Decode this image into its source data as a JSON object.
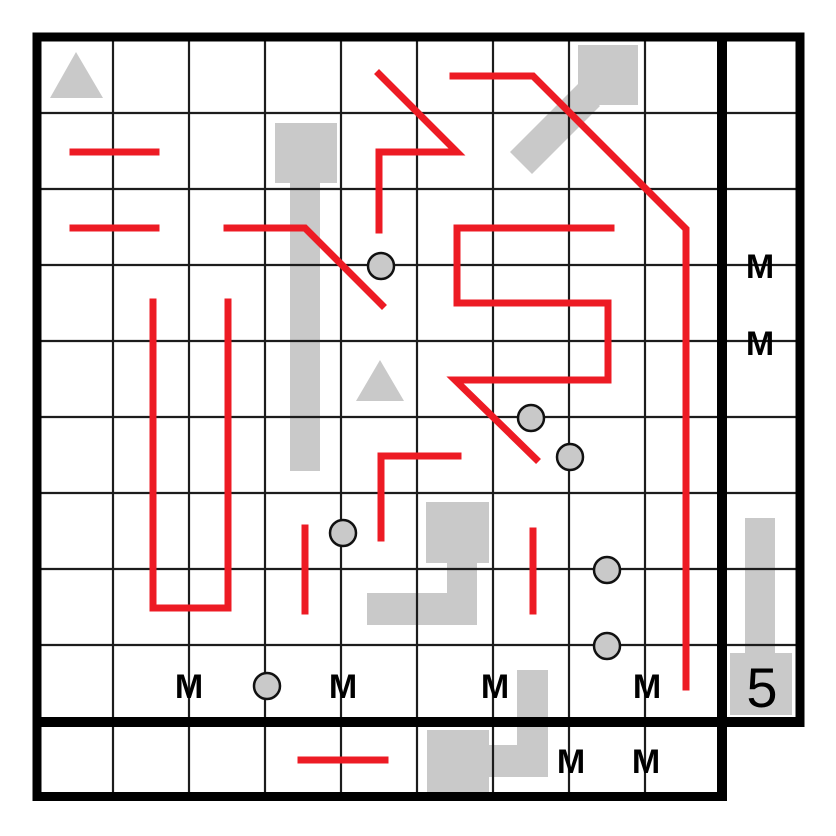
{
  "title": "Logic puzzle grid with red solution lines, gray pieces, circle markers, M clues and count clue 5",
  "canvas": {
    "width": 836,
    "height": 836
  },
  "colors": {
    "background": "#ffffff",
    "red": "#ed1b24",
    "shape_gray": "#c9c9c9",
    "circle_fill": "#c9c9c9",
    "circle_stroke": "#111111",
    "grid_thin": "#1c1c1c",
    "grid_bold": "#000000",
    "text": "#000000"
  },
  "grid": {
    "thin_width": 2.2,
    "bold_width": 9,
    "inner_bold_width": 10,
    "thin_vertical_x": [
      113,
      189,
      265,
      341,
      417,
      493,
      569,
      645
    ],
    "thin_vertical_span": [
      37,
      796
    ],
    "thin_horizontal_y": [
      113,
      189,
      265,
      341,
      417,
      493,
      569,
      645
    ],
    "thin_horizontal_span": [
      37,
      800
    ],
    "bold_lines": [
      {
        "x1": 32.5,
        "y1": 37,
        "x2": 804.5,
        "y2": 37,
        "w": 9
      },
      {
        "x1": 37,
        "y1": 32.5,
        "x2": 37,
        "y2": 801,
        "w": 9
      },
      {
        "x1": 800,
        "y1": 32.5,
        "x2": 800,
        "y2": 726.5,
        "w": 9
      },
      {
        "x1": 722,
        "y1": 32.5,
        "x2": 722,
        "y2": 801,
        "w": 10
      },
      {
        "x1": 32.5,
        "y1": 722,
        "x2": 804.5,
        "y2": 722,
        "w": 10
      },
      {
        "x1": 32.5,
        "y1": 796.5,
        "x2": 727,
        "y2": 796.5,
        "w": 9
      }
    ]
  },
  "red_line_width": 7,
  "red_paths": [
    {
      "name": "red-segment-row2-left",
      "points": [
        [
          73,
          152
        ],
        [
          156,
          152
        ]
      ]
    },
    {
      "name": "red-segment-row3-left",
      "points": [
        [
          73,
          228
        ],
        [
          156,
          228
        ]
      ]
    },
    {
      "name": "red-path-row3-diagonal",
      "points": [
        [
          227,
          228
        ],
        [
          305,
          228
        ],
        [
          382,
          305
        ]
      ]
    },
    {
      "name": "red-zigzag-top-middle",
      "points": [
        [
          379,
          74
        ],
        [
          457,
          152
        ],
        [
          379,
          152
        ],
        [
          379,
          230
        ]
      ]
    },
    {
      "name": "red-long-path-right",
      "points": [
        [
          453,
          76
        ],
        [
          533,
          76
        ],
        [
          686,
          229
        ],
        [
          686,
          687
        ]
      ]
    },
    {
      "name": "red-s-path-middle",
      "points": [
        [
          611,
          228
        ],
        [
          457,
          228
        ],
        [
          457,
          303
        ],
        [
          608,
          303
        ],
        [
          608,
          380
        ],
        [
          455,
          380
        ],
        [
          536,
          459
        ]
      ]
    },
    {
      "name": "red-u-path-left",
      "points": [
        [
          153,
          302
        ],
        [
          153,
          608
        ],
        [
          228,
          608
        ],
        [
          228,
          302
        ]
      ]
    },
    {
      "name": "red-l-path-center",
      "points": [
        [
          458,
          456
        ],
        [
          381,
          456
        ],
        [
          381,
          538
        ]
      ]
    },
    {
      "name": "red-segment-col4-vert",
      "points": [
        [
          305,
          528
        ],
        [
          305,
          611
        ]
      ]
    },
    {
      "name": "red-segment-col7-vert",
      "points": [
        [
          533,
          531
        ],
        [
          533,
          611
        ]
      ]
    },
    {
      "name": "red-segment-bottom-row",
      "points": [
        [
          301,
          760
        ],
        [
          385,
          760
        ]
      ]
    }
  ],
  "gray_pieces": [
    {
      "name": "gray-pin-down-col4",
      "polygons": [
        [
          [
            275,
            123
          ],
          [
            337,
            123
          ],
          [
            337,
            183
          ],
          [
            320,
            183
          ],
          [
            320,
            471
          ],
          [
            290,
            471
          ],
          [
            290,
            183
          ],
          [
            275,
            183
          ]
        ]
      ]
    },
    {
      "name": "gray-pin-diagonal-topright",
      "polygons": [
        [
          [
            578,
            45
          ],
          [
            638,
            45
          ],
          [
            638,
            105
          ],
          [
            578,
            105
          ]
        ],
        [
          [
            510,
            152
          ],
          [
            532,
            174
          ],
          [
            600,
            106
          ],
          [
            578,
            84
          ]
        ]
      ]
    },
    {
      "name": "gray-s-piece-middle",
      "polygons": [
        [
          [
            426,
            502
          ],
          [
            489,
            502
          ],
          [
            489,
            563
          ],
          [
            477,
            563
          ],
          [
            477,
            625
          ],
          [
            367,
            625
          ],
          [
            367,
            593
          ],
          [
            447,
            593
          ],
          [
            447,
            563
          ],
          [
            426,
            563
          ]
        ]
      ]
    },
    {
      "name": "gray-s-piece-bottom",
      "polygons": [
        [
          [
            517,
            670
          ],
          [
            548,
            670
          ],
          [
            548,
            777
          ],
          [
            489,
            777
          ],
          [
            489,
            792
          ],
          [
            427,
            792
          ],
          [
            427,
            730
          ],
          [
            489,
            730
          ],
          [
            489,
            745
          ],
          [
            517,
            745
          ]
        ]
      ]
    },
    {
      "name": "gray-pin-up-rightcolumn",
      "polygons": [
        [
          [
            745,
            518
          ],
          [
            775,
            518
          ],
          [
            775,
            653
          ],
          [
            792,
            653
          ],
          [
            792,
            715
          ],
          [
            730,
            715
          ],
          [
            730,
            653
          ],
          [
            745,
            653
          ]
        ]
      ]
    }
  ],
  "triangles": [
    {
      "name": "triangle-marker-top-left",
      "points": [
        [
          76,
          52
        ],
        [
          50,
          98
        ],
        [
          103,
          98
        ]
      ]
    },
    {
      "name": "triangle-marker-center",
      "points": [
        [
          380,
          360
        ],
        [
          356,
          401
        ],
        [
          404,
          401
        ]
      ]
    }
  ],
  "circle_radius": 13,
  "circles": [
    {
      "cx": 381,
      "cy": 266
    },
    {
      "cx": 531,
      "cy": 418
    },
    {
      "cx": 570,
      "cy": 457
    },
    {
      "cx": 343,
      "cy": 533
    },
    {
      "cx": 607,
      "cy": 570
    },
    {
      "cx": 607,
      "cy": 646
    },
    {
      "cx": 267,
      "cy": 686
    }
  ],
  "m_clue_char": "M",
  "m_font_size": 34,
  "m_labels": [
    {
      "x": 189,
      "y": 686
    },
    {
      "x": 343,
      "y": 686
    },
    {
      "x": 495,
      "y": 686
    },
    {
      "x": 647,
      "y": 686
    },
    {
      "x": 571,
      "y": 761
    },
    {
      "x": 646,
      "y": 761
    },
    {
      "x": 760,
      "y": 266
    },
    {
      "x": 760,
      "y": 343
    }
  ],
  "number_clue": {
    "text": "5",
    "x": 762,
    "y": 687,
    "font_size": 56
  }
}
